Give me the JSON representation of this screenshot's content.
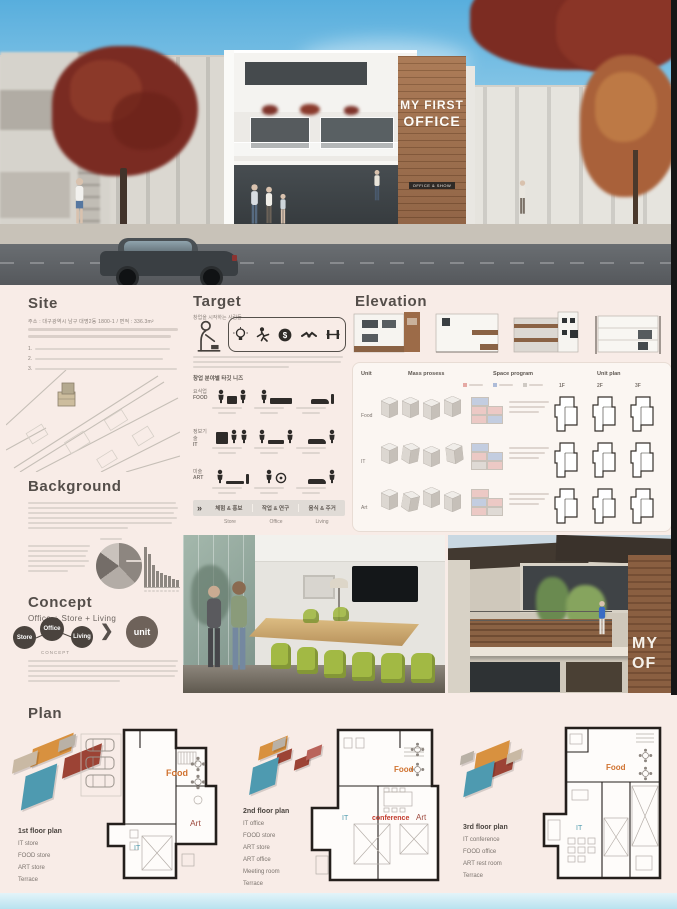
{
  "render": {
    "sign_line1": "MY FIRST",
    "sign_line2": "OFFICE",
    "sign_tagline": "OFFICE & SHOW",
    "photo_sign_line1": "MY",
    "photo_sign_line2": "OF"
  },
  "site": {
    "title": "Site",
    "address": "주소 : 대구광역시 남구 대명2동 1800-1  /  면적 : 336.3m²",
    "list_numbers": [
      "1.",
      "2.",
      "3."
    ]
  },
  "target": {
    "title": "Target",
    "subtitle": "창업을 시작하는 사람들",
    "needs_title": "창업 분야별 타깃 니즈",
    "rows": [
      {
        "ko": "요식업",
        "en": "FOOD"
      },
      {
        "ko": "정보기술",
        "en": "IT"
      },
      {
        "ko": "미술",
        "en": "ART"
      }
    ],
    "footer_chevron": "»",
    "footer_labels": [
      "체험 & 홍보",
      "작업 & 연구",
      "음식 & 주거"
    ],
    "footer_en": [
      "Store",
      "Office",
      "Living"
    ]
  },
  "elevation": {
    "title": "Elevation",
    "headers": [
      "Unit",
      "Mass prosess",
      "Space program",
      "Unit plan"
    ],
    "rows": [
      "Food",
      "IT",
      "Art"
    ],
    "floors": [
      "1F",
      "2F",
      "3F"
    ]
  },
  "background": {
    "title": "Background",
    "chart_data": [
      {
        "type": "pie",
        "values": [
          38,
          27,
          20,
          15
        ]
      },
      {
        "type": "bar",
        "values": [
          34,
          28,
          19,
          14,
          12,
          10,
          9,
          7,
          6
        ]
      }
    ]
  },
  "concept": {
    "title": "Concept",
    "subtitle": "Office + Store + Living",
    "circles": [
      "Store",
      "Office",
      "Living"
    ],
    "caption": "CONCEPT",
    "unit": "unit"
  },
  "plan": {
    "title": "Plan",
    "floors": [
      {
        "name": "1st floor plan",
        "items": [
          "IT store",
          "FOOD store",
          "ART store",
          "Terrace"
        ],
        "labels": {
          "food": "Food",
          "it": "IT",
          "art": "Art"
        }
      },
      {
        "name": "2nd floor plan",
        "items": [
          "IT office",
          "FOOD store",
          "ART store",
          "ART office",
          "Meeting room",
          "Terrace"
        ],
        "labels": {
          "food": "Food",
          "it": "IT",
          "conf": "conference",
          "art": "Art"
        }
      },
      {
        "name": "3rd floor plan",
        "items": [
          "IT conference",
          "FOOD office",
          "ART rest room",
          "Terrace"
        ],
        "labels": {
          "food": "Food",
          "it": "IT"
        }
      }
    ]
  },
  "colors": {
    "poster_bg": "#f8ece7",
    "accent_orange": "#d0722f",
    "accent_teal": "#4f9bae",
    "accent_red": "#9e4a3e",
    "wood": "#96663f",
    "bottom_strip": "#c9e7f2"
  }
}
